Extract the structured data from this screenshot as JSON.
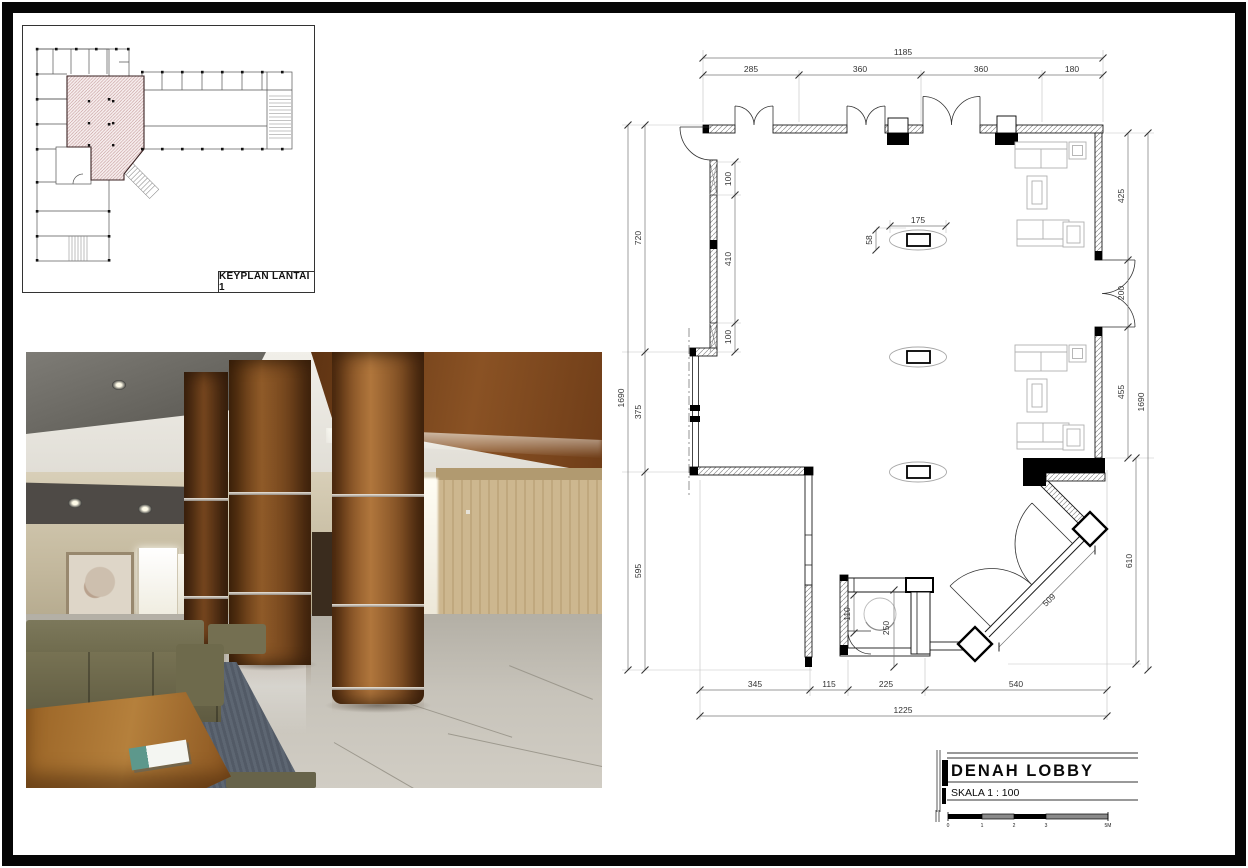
{
  "keyplan": {
    "label": "KEYPLAN LANTAI 1"
  },
  "titleblock": {
    "title": "DENAH  LOBBY",
    "scale_label": "SKALA 1 : 100",
    "scalebar_ticks": [
      "0",
      "1",
      "2",
      "3",
      "5M"
    ]
  },
  "floorplan": {
    "dims": {
      "top_total": "1185",
      "top": [
        "285",
        "360",
        "360",
        "180"
      ],
      "left_total": "1690",
      "left": [
        "720",
        "375",
        "595"
      ],
      "left_inner": [
        "100",
        "410",
        "100"
      ],
      "right_total": "1690",
      "right": [
        "425",
        "200",
        "455"
      ],
      "right_lower": "610",
      "bottom": [
        "345",
        "115",
        "225",
        "540"
      ],
      "bottom_total": "1225",
      "column_width": "175",
      "column_depth": "58",
      "counter_depth": "110",
      "counter_width": "250",
      "diagonal_wall": "509"
    }
  },
  "colors": {
    "keyplan_hatch": "#bb8d8d",
    "wood_column": "#9a5f2e",
    "sofa_olive": "#6b674a",
    "marble_floor": "#bfbbb2",
    "carpet_blue": "#5c6673",
    "wall_hatch": "#909090"
  }
}
